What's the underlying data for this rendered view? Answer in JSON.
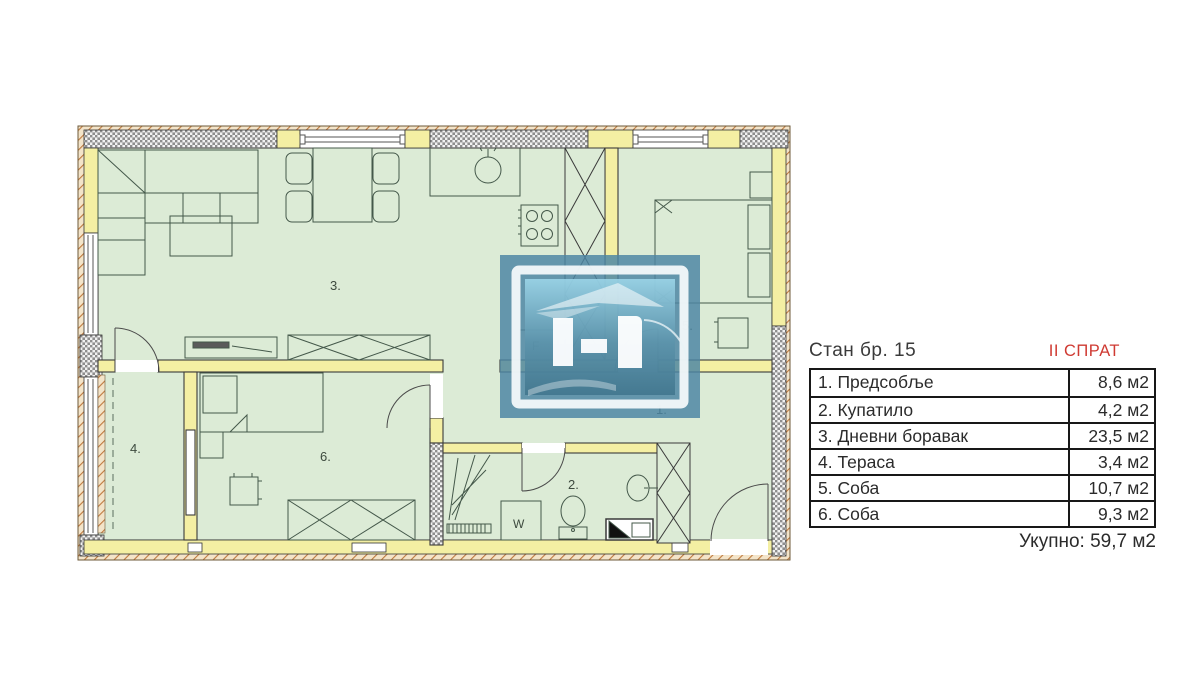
{
  "panel": {
    "title": "Стан бр. 15",
    "floor_label": "II СПРАТ",
    "table": {
      "rows": [
        {
          "name": "1. Предсобље",
          "area": "8,6 м2"
        },
        {
          "name": "2. Купатило",
          "area": "4,2 м2"
        },
        {
          "name": "3. Дневни боравак",
          "area": "23,5 м2"
        },
        {
          "name": "4. Тераса",
          "area": "3,4 м2"
        },
        {
          "name": "5. Соба",
          "area": "10,7 м2"
        },
        {
          "name": "6. Соба",
          "area": "9,3 м2"
        }
      ]
    },
    "total_label": "Укупно: 59,7 м2"
  },
  "floorplan": {
    "room_labels": {
      "hallway": "1.",
      "bathroom": "2.",
      "living": "3.",
      "terrace": "4.",
      "bedroom5": "5.",
      "bedroom6": "6."
    },
    "fixture_labels": {
      "fridge": "F",
      "washer": "W"
    },
    "colors": {
      "room_fill": "#dcebd6",
      "wall_yellow": "#f4efa3",
      "accent_red": "#cf3a32",
      "logo_blue": "#4c86a3"
    }
  }
}
